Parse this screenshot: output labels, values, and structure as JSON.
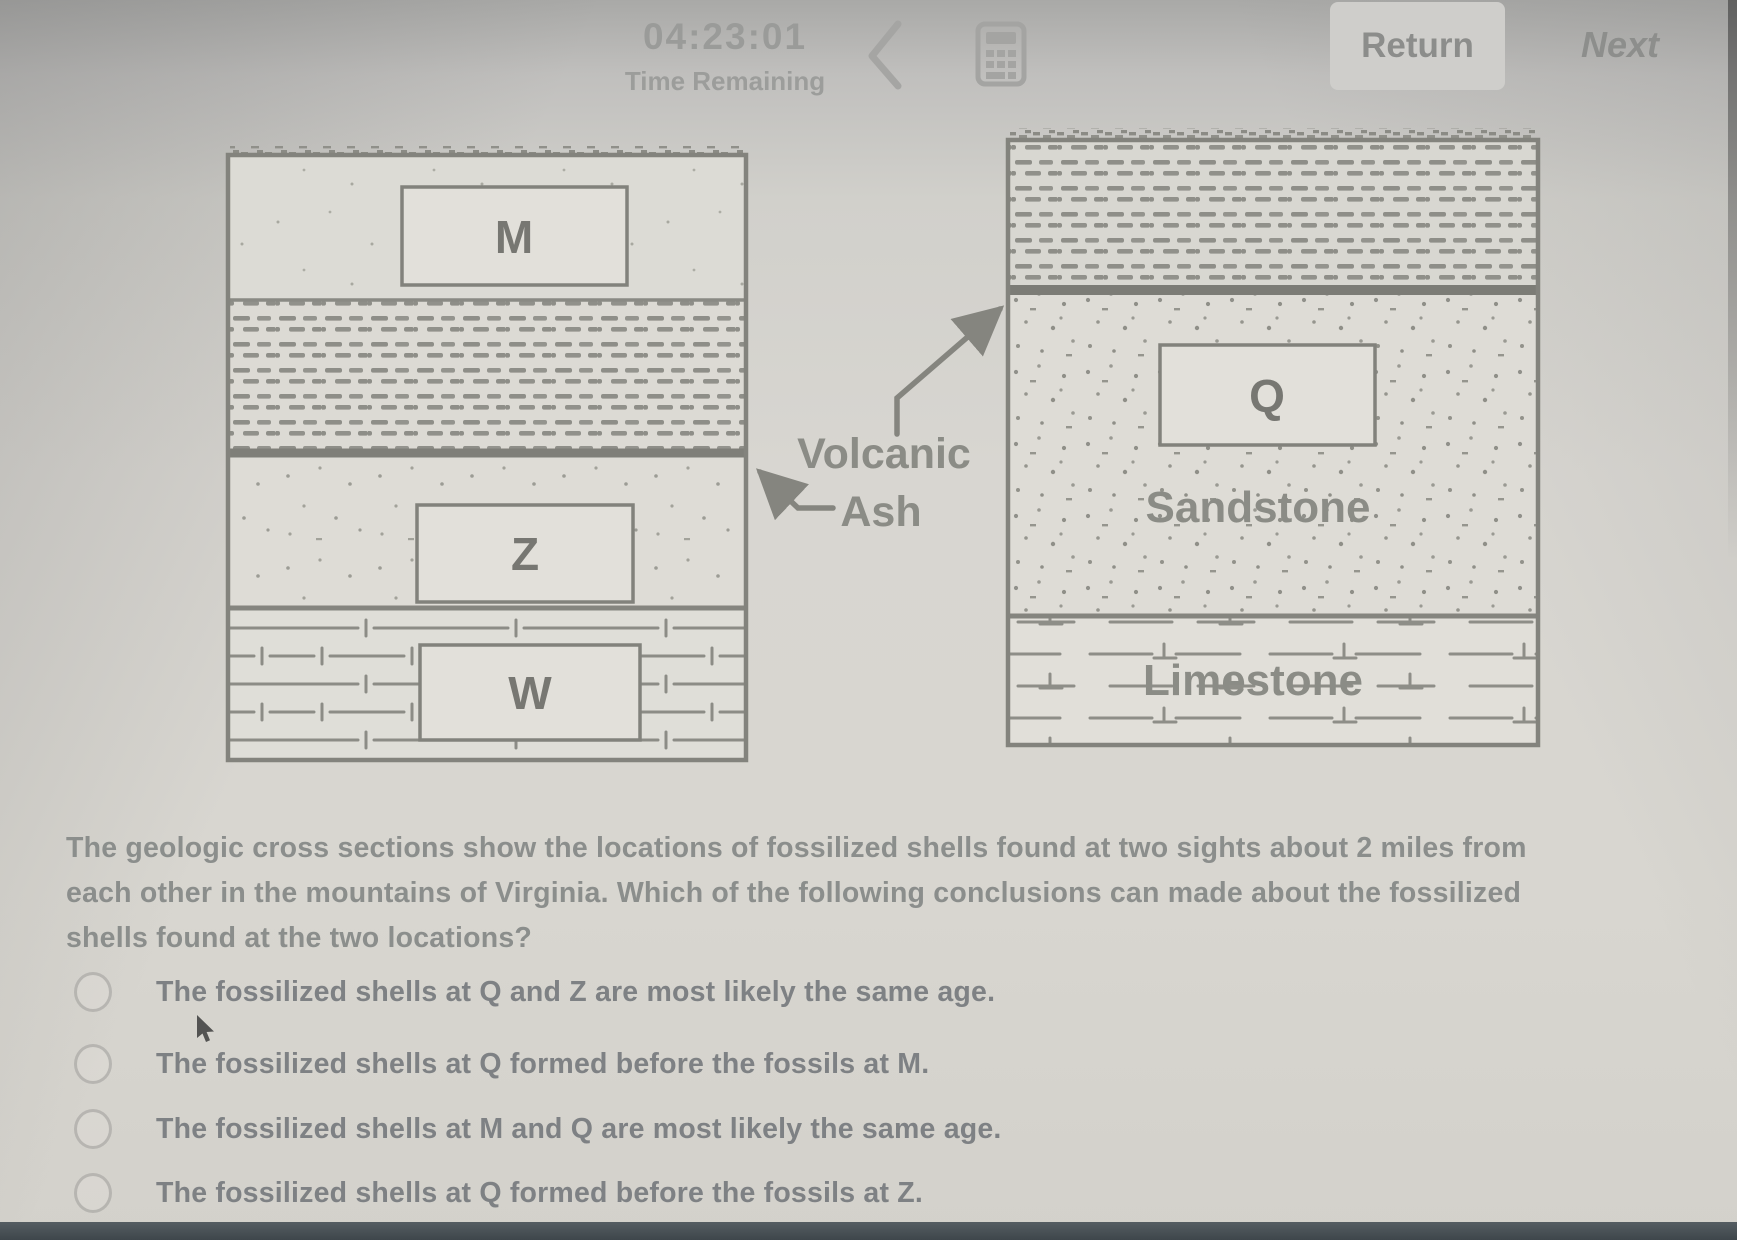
{
  "topbar": {
    "timer_value": "04:23:01",
    "timer_label": "Time Remaining",
    "return_label": "Return",
    "next_label": "Next"
  },
  "figure": {
    "left_section": {
      "box_m": "M",
      "box_z": "Z",
      "box_w": "W"
    },
    "right_section": {
      "box_q": "Q",
      "sandstone_label": "Sandstone",
      "limestone_label": "Limestone"
    },
    "annotation_line1": "Volcanic",
    "annotation_line2": "Ash"
  },
  "question": {
    "text": "The geologic cross sections show the locations of fossilized shells found at two sights about 2 miles from each other in the mountains of Virginia.  Which of the following conclusions can made about the fossilized shells found at the two locations?"
  },
  "options": [
    {
      "label": "The fossilized shells at Q and Z are most likely the same age."
    },
    {
      "label": "The fossilized shells at Q formed before the fossils at M."
    },
    {
      "label": "The fossilized shells at M and Q are most likely the same age."
    },
    {
      "label": "The fossilized shells at Q formed before the fossils at Z."
    }
  ],
  "colors": {
    "diagram_line": "#83837d",
    "pattern_ink": "#8e8e88",
    "question_text": "#8b8e8c",
    "option_text": "#7e8184",
    "bottom_bar": "#3e464b"
  }
}
